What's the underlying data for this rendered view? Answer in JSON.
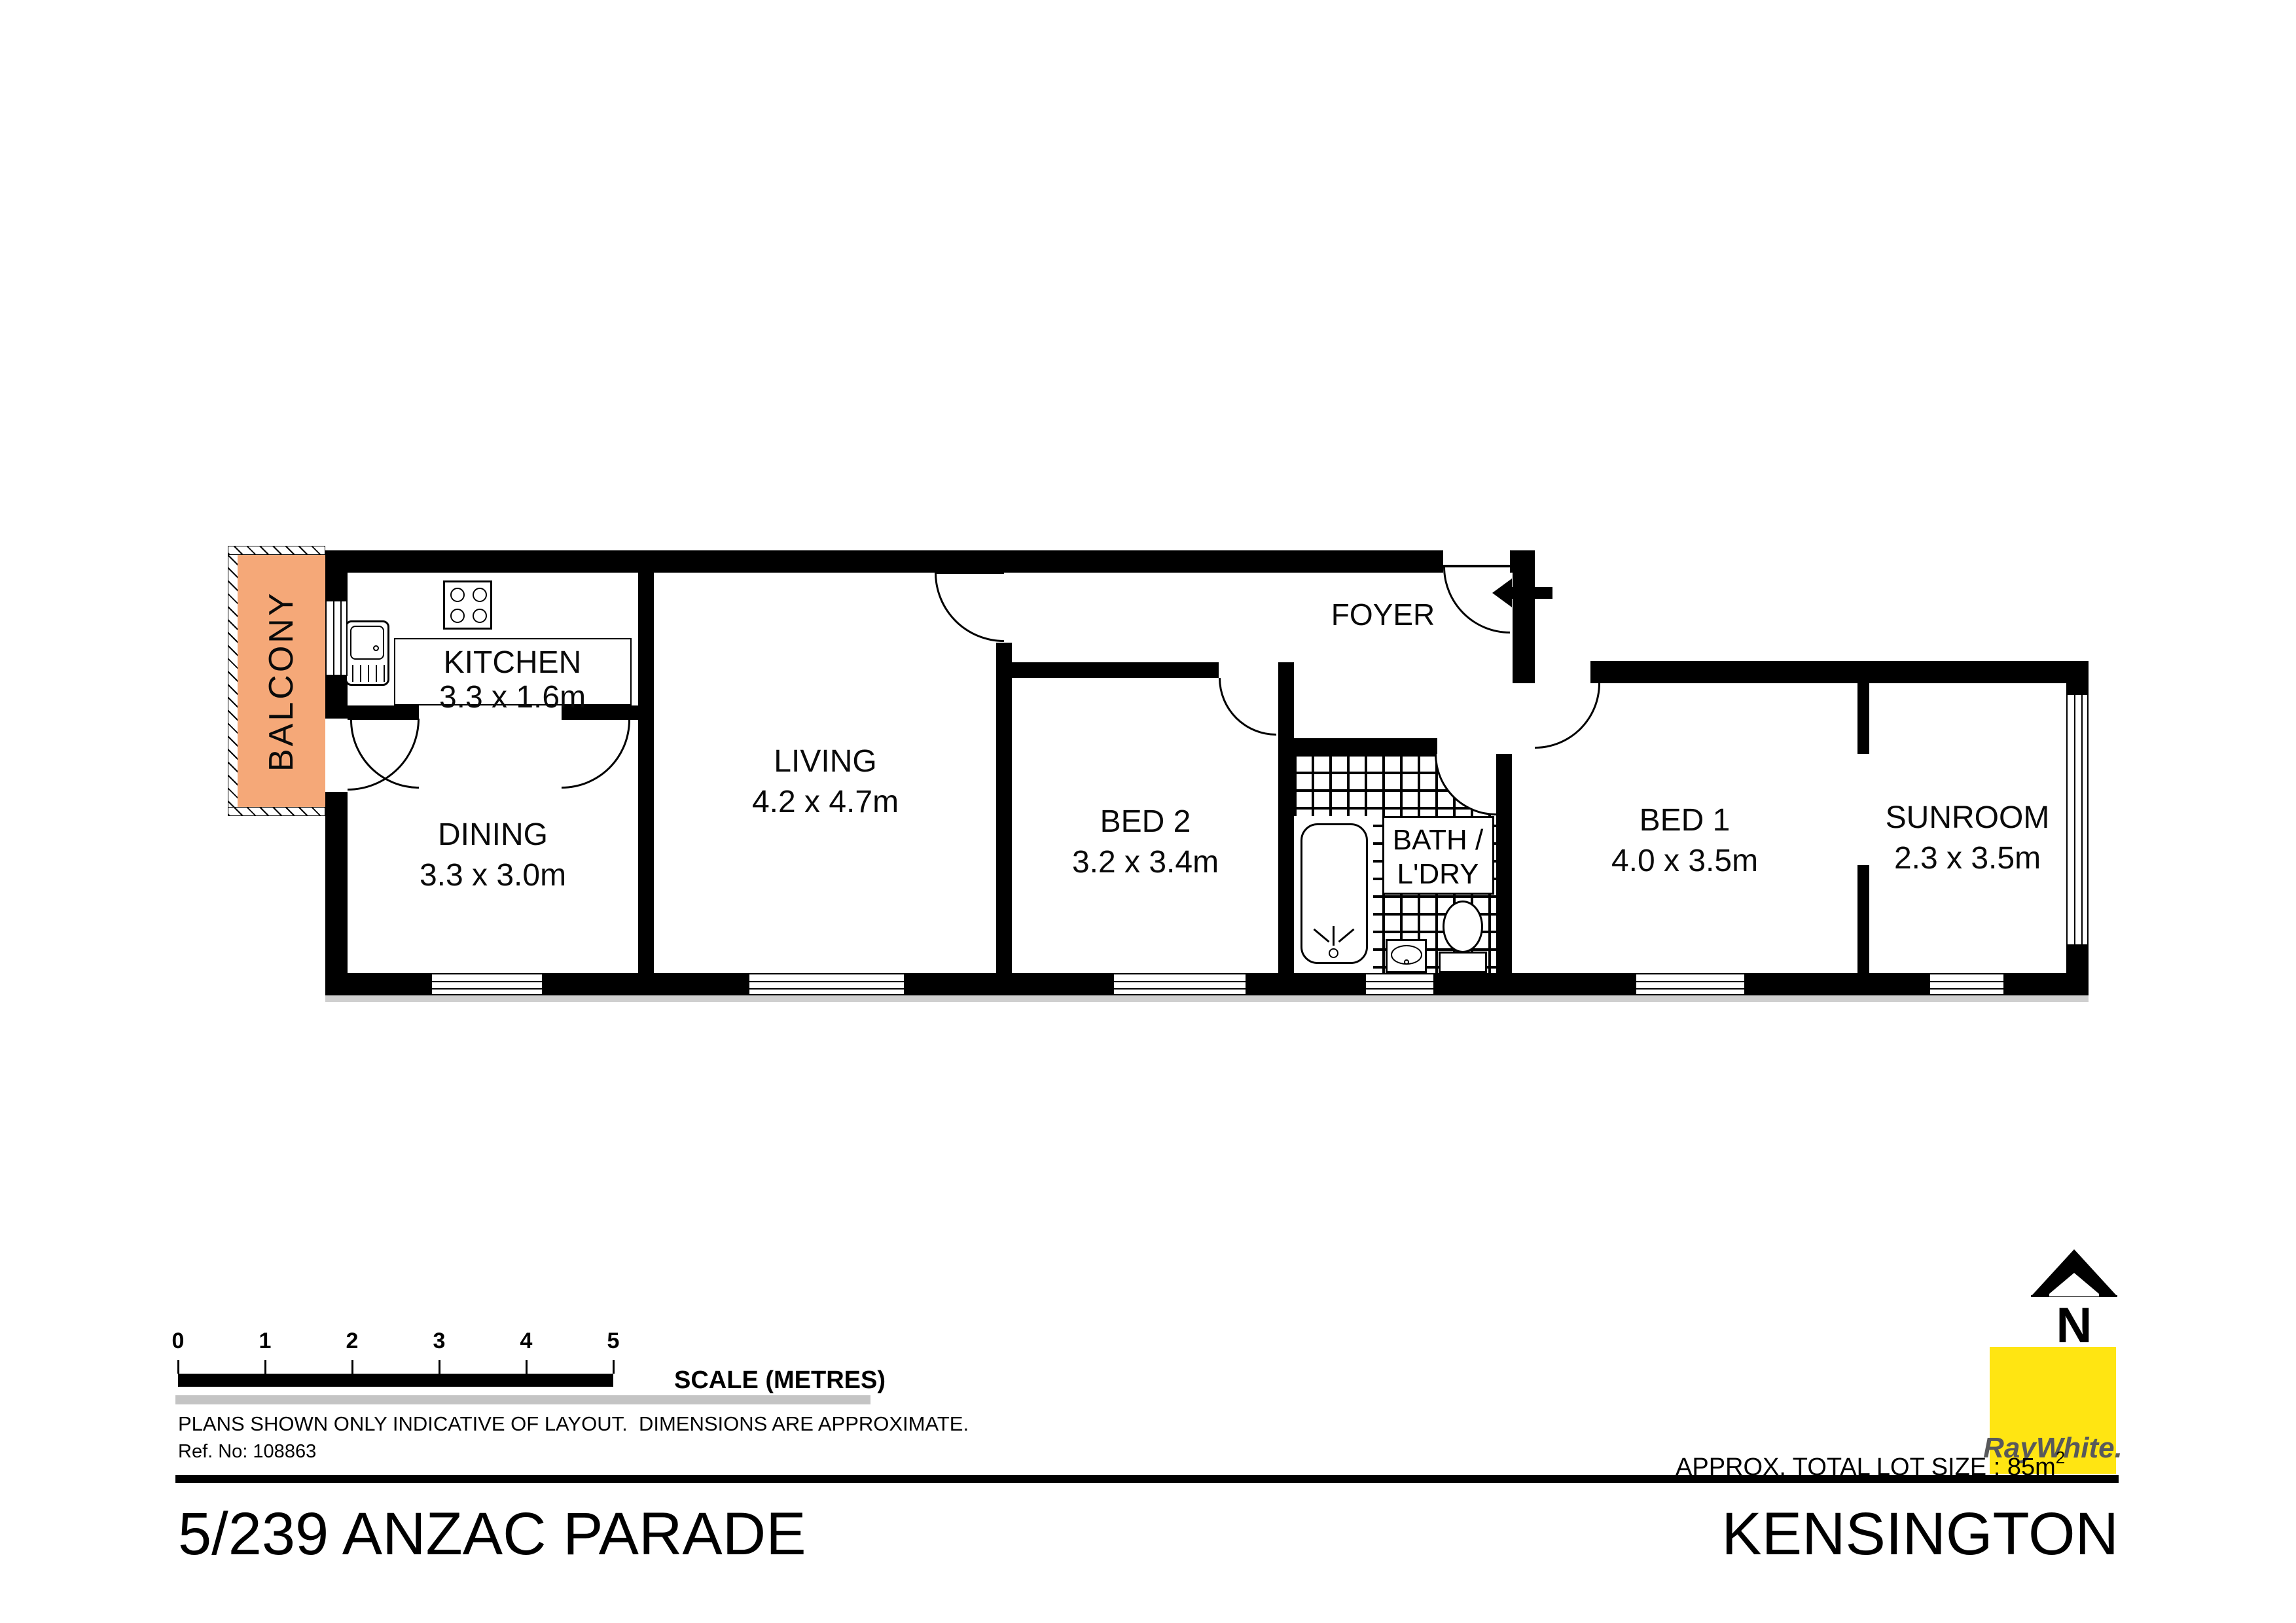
{
  "plan": {
    "rooms": {
      "balcony": {
        "name": "BALCONY"
      },
      "kitchen": {
        "name": "KITCHEN",
        "dims": "3.3 x 1.6m"
      },
      "dining": {
        "name": "DINING",
        "dims": "3.3 x 3.0m"
      },
      "living": {
        "name": "LIVING",
        "dims": "4.2 x 4.7m"
      },
      "bed2": {
        "name": "BED 2",
        "dims": "3.2 x 3.4m"
      },
      "bath": {
        "name_line1": "BATH /",
        "name_line2": "L'DRY"
      },
      "foyer": {
        "name": "FOYER"
      },
      "bed1": {
        "name": "BED 1",
        "dims": "4.0 x 3.5m"
      },
      "sunroom": {
        "name": "SUNROOM",
        "dims": "2.3 x 3.5m"
      }
    }
  },
  "scale_bar": {
    "ticks": [
      "0",
      "1",
      "2",
      "3",
      "4",
      "5"
    ],
    "label": "SCALE (METRES)"
  },
  "notes": {
    "disclaimer": "PLANS SHOWN ONLY INDICATIVE OF LAYOUT.  DIMENSIONS ARE APPROXIMATE.",
    "ref": "Ref. No: 108863"
  },
  "footer": {
    "address": "5/239 ANZAC PARADE",
    "suburb": "KENSINGTON",
    "lot_size": "APPROX. TOTAL LOT SIZE : 85m",
    "lot_size_sup": "2"
  },
  "branding": {
    "agency": "RayWhite.",
    "north_letter": "N"
  },
  "colors": {
    "balcony_fill": "#F5A878",
    "brand_yellow": "#FFE512",
    "brand_text": "#58595B"
  }
}
